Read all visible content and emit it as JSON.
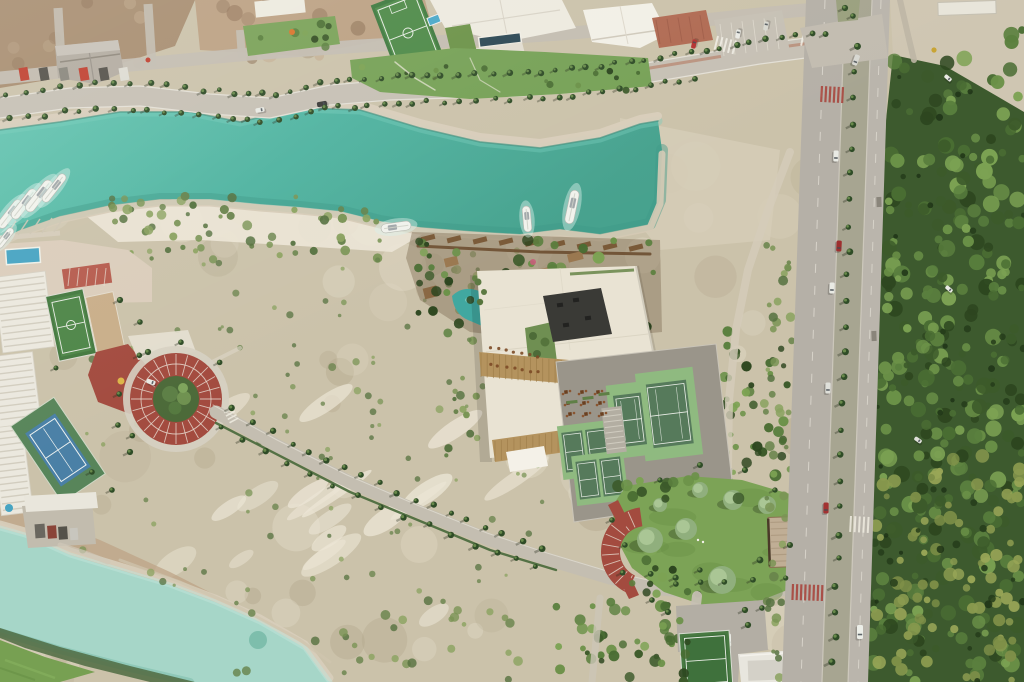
{
  "scene": {
    "description": "Aerial drone view of a coastal resort development: turquoise canal with marina and boats, beach club with pools and boardwalk, central clubhouse with tennis and pickleball courts, red-brick roundabout, palm-lined roads, a boulevard with median palms, dense mangrove forest, a lawn park with pavilion, scrubland and a second pale canal",
    "features": [
      "construction site",
      "canal",
      "marina",
      "beach club pools",
      "boardwalk",
      "clubhouse",
      "tennis courts",
      "pickleball courts",
      "brick roundabout",
      "palm-lined road",
      "boulevard",
      "mangrove forest",
      "park pavilion",
      "padel court",
      "second canal",
      "scrubland",
      "soccer field",
      "blue tennis court",
      "futsal court",
      "lap pool"
    ]
  },
  "objects": {
    "marina_yachts": 5,
    "canal_boats": 3,
    "boulevard_cars": 7,
    "forest_cars": 3,
    "roundabout_cars": 1
  },
  "palette": {
    "sandBase": "#cbc2aa",
    "sandLight": "#e2dbc8",
    "sandWhite": "#ece6d6",
    "sandDark": "#b3a78c",
    "dirtBrown": "#a88e71",
    "dirtLight": "#bca183",
    "canal": "#52b8a4",
    "canalDeep": "#3f9a88",
    "canalLight": "#78cdbb",
    "bankRock": "#d8cebb",
    "waterline": "#357f70",
    "canal2": "#a6d6c8",
    "canal2Deep": "#74b8a5",
    "roadGray": "#c6c0b4",
    "roadLight": "#d4cec2",
    "blvdRoad": "#b5b0a7",
    "medianGray": "#a7a591",
    "bldgWhite": "#edeadf",
    "cream": "#e9e3d3",
    "wood": "#b4935e",
    "woodDark": "#99794a",
    "darkRoof": "#3a3a36",
    "brick": "#a34b3f",
    "brickLight": "#b65c4e",
    "lawn": "#7ca356",
    "lawnDark": "#688f45",
    "sage": "#90af7d",
    "sageLight": "#aac695",
    "apron": "#8fba80",
    "court": "#567a5b",
    "blueCourt": "#4a80a6",
    "futsal": "#44793f",
    "padGray": "#9a958a",
    "pool": "#41a8a0",
    "poolLight": "#7fd0c6",
    "lapPool": "#2c4854",
    "palmDark": "#2f4c27",
    "palmLight": "#6f9150",
    "carRed": "#a23232",
    "carWhite": "#e9eae4",
    "forest": [
      "#2d461f",
      "#3c5a2a",
      "#4a6d33",
      "#5a7f3e",
      "#6b9148",
      "#7ca253"
    ],
    "olive": [
      "#8a9a4f",
      "#99a657",
      "#7e8f48"
    ],
    "scrub": [
      "#55713f",
      "#67824a",
      "#7a9455",
      "#8aa25f"
    ]
  }
}
